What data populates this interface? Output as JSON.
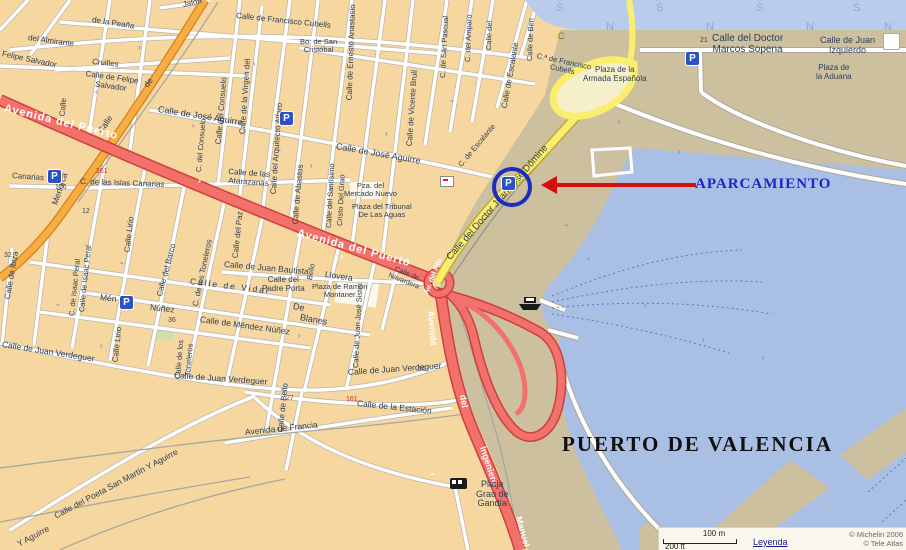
{
  "map": {
    "port_title": "PUERTO DE VALENCIA",
    "annotation": {
      "label": "APARCAMIENTO"
    },
    "legend": {
      "scale_m": "100 m",
      "scale_ft": "200 ft",
      "link": "Leyenda",
      "copyright1": "© Michelin 2006",
      "copyright2": "© Tele Atlas"
    },
    "colors": {
      "background_city": "#F7D7A0",
      "port_land": "#CDC09E",
      "water": "#A9BFE4",
      "water_top": "#B9CCEC",
      "road_red": "#F3716B",
      "road_orange": "#F7AD42",
      "road_yellow": "#FBEE6E",
      "parking_blue": "#2B51C8",
      "annotation_blue": "#2121CE",
      "arrow_red": "#D40F0F"
    },
    "parking_glyph": "P",
    "parking": [
      {
        "x": 48,
        "y": 170,
        "circled": false
      },
      {
        "x": 280,
        "y": 112,
        "circled": false
      },
      {
        "x": 120,
        "y": 296,
        "circled": false
      },
      {
        "x": 686,
        "y": 52,
        "circled": false
      },
      {
        "x": 502,
        "y": 177,
        "circled": true
      }
    ],
    "labels": [
      {
        "t": "Jalón",
        "x": 183,
        "y": 1,
        "r": -12,
        "s": 8
      },
      {
        "t": "Calle de Francisco Cubells",
        "x": 236,
        "y": 12,
        "r": 6,
        "s": 8
      },
      {
        "t": "de  la  Peaña",
        "x": 92,
        "y": 16,
        "r": 9,
        "s": 8
      },
      {
        "t": "del Almirante",
        "x": 28,
        "y": 34,
        "r": 8,
        "s": 8
      },
      {
        "t": "Felipe Salvador",
        "x": 2,
        "y": 50,
        "r": 12,
        "s": 8
      },
      {
        "t": "Cruilles",
        "x": 92,
        "y": 58,
        "r": 6,
        "s": 8
      },
      {
        "t": "Calle de Felipe\nSalvador",
        "x": 85,
        "y": 70,
        "r": 8,
        "s": 8,
        "ctr": 1
      },
      {
        "t": "Calle",
        "x": 63,
        "y": 112,
        "r": -85,
        "s": 8
      },
      {
        "t": "Calle",
        "x": 100,
        "y": 128,
        "r": -56,
        "s": 8.5
      },
      {
        "t": "de",
        "x": 146,
        "y": 82,
        "r": -56,
        "s": 8.5
      },
      {
        "t": "Menorca",
        "x": 55,
        "y": 200,
        "r": -72,
        "s": 8.5
      },
      {
        "t": "Avenida del Puerto",
        "x": 4,
        "y": 103,
        "r": 14,
        "s": 11,
        "c": "#ffffff",
        "b": 1,
        "ls": 1
      },
      {
        "t": "Avenida del Puerto",
        "x": 297,
        "y": 228,
        "r": 15,
        "s": 11,
        "c": "#ffffff",
        "b": 1,
        "ls": 1
      },
      {
        "t": "Canarias",
        "x": 12,
        "y": 172,
        "r": 4,
        "s": 8
      },
      {
        "t": "C. de las Islas Canarias",
        "x": 80,
        "y": 178,
        "r": 2,
        "s": 8
      },
      {
        "t": "Calle de Ernesto Anastasio",
        "x": 350,
        "y": 96,
        "r": -88,
        "s": 8
      },
      {
        "t": "Calle de Vicente Brull",
        "x": 410,
        "y": 142,
        "r": -86,
        "s": 8
      },
      {
        "t": "C. de San Pascual",
        "x": 443,
        "y": 74,
        "r": -87,
        "s": 7.5
      },
      {
        "t": "C. del Amparo",
        "x": 468,
        "y": 58,
        "r": -88,
        "s": 7.5
      },
      {
        "t": "Calle del",
        "x": 489,
        "y": 46,
        "r": -88,
        "s": 7.5
      },
      {
        "t": "Calle de Escalante",
        "x": 505,
        "y": 104,
        "r": -80,
        "s": 8
      },
      {
        "t": "C. de Escalante",
        "x": 460,
        "y": 162,
        "r": -50,
        "s": 7.5
      },
      {
        "t": "Calle de Ben",
        "x": 530,
        "y": 57,
        "r": -88,
        "s": 7.5
      },
      {
        "t": "C.ª de Francisco\nCubells",
        "x": 536,
        "y": 52,
        "r": 12,
        "s": 7.5,
        "ctr": 1
      },
      {
        "t": "Calle de José Aguirre",
        "x": 158,
        "y": 105,
        "r": 9,
        "s": 9
      },
      {
        "t": "Calle de José  Aguirre",
        "x": 336,
        "y": 142,
        "r": 10,
        "s": 9
      },
      {
        "t": "Calle del Consuelo",
        "x": 219,
        "y": 140,
        "r": -85,
        "s": 8
      },
      {
        "t": "C. del Consuelo",
        "x": 199,
        "y": 168,
        "r": -85,
        "s": 7.5
      },
      {
        "t": "Calle de la Virgen del",
        "x": 243,
        "y": 130,
        "r": -86,
        "s": 8
      },
      {
        "t": "Calle del Arquitecto Alfaro",
        "x": 274,
        "y": 190,
        "r": -86,
        "s": 8
      },
      {
        "t": "Calle de las\nAtarazanas",
        "x": 228,
        "y": 168,
        "r": 4,
        "s": 8,
        "ctr": 1
      },
      {
        "t": "Bo. de San\nCristóbal",
        "x": 300,
        "y": 38,
        "s": 7.5,
        "ctr": 1
      },
      {
        "t": "Pza. del\nMercado Nuevo",
        "x": 344,
        "y": 182,
        "s": 7.5,
        "ctr": 1
      },
      {
        "t": "Plaza del Tribunal\nDe Las Aguas",
        "x": 352,
        "y": 203,
        "s": 7.5,
        "ctr": 1
      },
      {
        "t": "Calle de Abastos",
        "x": 296,
        "y": 220,
        "r": -85,
        "s": 8
      },
      {
        "t": "Calle del Santísimo",
        "x": 329,
        "y": 224,
        "r": -87,
        "s": 7.5
      },
      {
        "t": "Cristo Del Grao",
        "x": 340,
        "y": 222,
        "r": -87,
        "s": 7.5
      },
      {
        "t": "Calle de Ibiza",
        "x": 8,
        "y": 295,
        "r": -80,
        "s": 8
      },
      {
        "t": "Calle de Isaac Peral",
        "x": 82,
        "y": 308,
        "r": -84,
        "s": 7.5
      },
      {
        "t": "C. de Isaac Peral",
        "x": 72,
        "y": 312,
        "r": -84,
        "s": 7.5
      },
      {
        "t": "Calle Lirio",
        "x": 128,
        "y": 248,
        "r": -84,
        "s": 8
      },
      {
        "t": "Calle Lirio",
        "x": 116,
        "y": 358,
        "r": -84,
        "s": 8
      },
      {
        "t": "Calle del Barco",
        "x": 160,
        "y": 292,
        "r": -75,
        "s": 8
      },
      {
        "t": "C. de los Toneleros",
        "x": 196,
        "y": 302,
        "r": -78,
        "s": 8
      },
      {
        "t": "Calle de los",
        "x": 178,
        "y": 375,
        "r": -85,
        "s": 7.5
      },
      {
        "t": "Toneleros",
        "x": 188,
        "y": 372,
        "r": -85,
        "s": 7.5
      },
      {
        "t": "Calle del Paz",
        "x": 236,
        "y": 254,
        "r": -84,
        "s": 8
      },
      {
        "t": "Calle de Juan Bautista",
        "x": 224,
        "y": 260,
        "r": 5,
        "s": 8.5
      },
      {
        "t": "Llovera",
        "x": 325,
        "y": 270,
        "r": 8,
        "s": 8.5
      },
      {
        "t": "Calle del\nPadre Porta",
        "x": 262,
        "y": 276,
        "s": 8,
        "ctr": 1
      },
      {
        "t": "Plaza de Ramón\nMontaner",
        "x": 312,
        "y": 283,
        "s": 7.5,
        "ctr": 1
      },
      {
        "t": "Calle   de   Vidal",
        "x": 190,
        "y": 277,
        "r": 7,
        "s": 8.5,
        "ls": 2
      },
      {
        "t": "Mén",
        "x": 100,
        "y": 293,
        "r": 6,
        "s": 8.5
      },
      {
        "t": "Núñez",
        "x": 150,
        "y": 303,
        "r": 6,
        "s": 8.5
      },
      {
        "t": "Calle de Méndez  Núñez",
        "x": 200,
        "y": 315,
        "r": 8,
        "s": 8.5
      },
      {
        "t": "De",
        "x": 293,
        "y": 302,
        "r": 10,
        "s": 9
      },
      {
        "t": "Blanes",
        "x": 300,
        "y": 313,
        "r": 10,
        "s": 9
      },
      {
        "t": "Calle de Bello",
        "x": 281,
        "y": 428,
        "r": -84,
        "s": 8
      },
      {
        "t": "Bello",
        "x": 310,
        "y": 276,
        "r": -80,
        "s": 7.5
      },
      {
        "t": "Calle de Juan José Sister",
        "x": 356,
        "y": 364,
        "r": -87,
        "s": 7.5
      },
      {
        "t": "Calle de\nNavardera",
        "x": 390,
        "y": 264,
        "r": 22,
        "s": 7,
        "ctr": 1
      },
      {
        "t": "Calle de Juan Verdeguer",
        "x": 2,
        "y": 340,
        "r": 9,
        "s": 8.5
      },
      {
        "t": "Calle de Juan Verdeguer",
        "x": 174,
        "y": 371,
        "r": 4,
        "s": 8.5
      },
      {
        "t": "Calle de Juan Verdeguer",
        "x": 348,
        "y": 368,
        "r": -4,
        "s": 8.5
      },
      {
        "t": "Calle de  la Estación",
        "x": 357,
        "y": 399,
        "r": 6,
        "s": 8.5
      },
      {
        "t": "Avenida  de  Francia",
        "x": 245,
        "y": 428,
        "r": -6,
        "s": 8.5
      },
      {
        "t": "Calle del Poeta San Martín Y Aguirre",
        "x": 55,
        "y": 512,
        "r": -28,
        "s": 8.5
      },
      {
        "t": "Y Aguirre",
        "x": 18,
        "y": 540,
        "r": -28,
        "s": 8.5
      },
      {
        "t": "Av. del Pto.",
        "x": 426,
        "y": 290,
        "r": -68,
        "s": 7.5,
        "c": "#ffffff",
        "b": 1
      },
      {
        "t": "Avenida",
        "x": 430,
        "y": 306,
        "r": 85,
        "s": 9,
        "c": "#ffffff",
        "b": 1
      },
      {
        "t": "del",
        "x": 462,
        "y": 390,
        "r": 80,
        "s": 9,
        "c": "#ffffff",
        "b": 1
      },
      {
        "t": "Ingeniero",
        "x": 482,
        "y": 442,
        "r": 72,
        "s": 9,
        "c": "#ffffff",
        "b": 1
      },
      {
        "t": "Manuel",
        "x": 518,
        "y": 512,
        "r": 75,
        "s": 9,
        "c": "#ffffff",
        "b": 1
      },
      {
        "t": "Calle del Doctor Juan José Dómine",
        "x": 449,
        "y": 254,
        "r": -49,
        "s": 9.5
      },
      {
        "t": "Calle del Doctor\nMarcos Sopena",
        "x": 712,
        "y": 34,
        "s": 10,
        "ctr": 1
      },
      {
        "t": "Calle de Juan\nIzquierdo",
        "x": 820,
        "y": 36,
        "s": 9,
        "ctr": 1
      },
      {
        "t": "Plaza de\nla Aduana",
        "x": 816,
        "y": 64,
        "s": 8,
        "ctr": 1
      },
      {
        "t": "Plaza de la\nArmada Española",
        "x": 583,
        "y": 66,
        "s": 8,
        "ctr": 1
      },
      {
        "t": "Platja\nGrau de\nGandía",
        "x": 476,
        "y": 480,
        "s": 9,
        "ctr": 1
      },
      {
        "t": "C",
        "x": 558,
        "y": 32,
        "s": 9,
        "c": "#8a7a00",
        "n": "road-badge"
      },
      {
        "t": "21",
        "x": 700,
        "y": 37,
        "s": 7,
        "c": "#444444",
        "n": "house-number"
      },
      {
        "t": "161",
        "x": 346,
        "y": 396,
        "s": 7,
        "c": "#C03020",
        "n": "house-number"
      },
      {
        "t": "50",
        "x": 418,
        "y": 366,
        "s": 7,
        "c": "#444444",
        "n": "house-number"
      },
      {
        "t": "261",
        "x": 96,
        "y": 168,
        "s": 7,
        "c": "#C03020",
        "n": "house-number"
      },
      {
        "t": "176",
        "x": 55,
        "y": 184,
        "s": 7,
        "c": "#444444",
        "n": "house-number"
      },
      {
        "t": "12",
        "x": 82,
        "y": 208,
        "s": 7,
        "c": "#444444",
        "n": "house-number"
      },
      {
        "t": "32",
        "x": 4,
        "y": 252,
        "s": 7,
        "c": "#444444",
        "n": "house-number"
      },
      {
        "t": "36",
        "x": 168,
        "y": 317,
        "s": 7,
        "c": "#444444",
        "n": "house-number"
      },
      {
        "t": "27",
        "x": 286,
        "y": 395,
        "s": 7,
        "c": "#C03020",
        "n": "house-number"
      },
      {
        "t": "Ṡ",
        "x": 556,
        "y": 3,
        "s": 11,
        "c": "#8FA9D6",
        "n": "water-symbol"
      },
      {
        "t": "Ṡ",
        "x": 656,
        "y": 3,
        "s": 11,
        "c": "#8FA9D6",
        "n": "water-symbol"
      },
      {
        "t": "Ṡ",
        "x": 756,
        "y": 3,
        "s": 11,
        "c": "#8FA9D6",
        "n": "water-symbol"
      },
      {
        "t": "Ṡ",
        "x": 853,
        "y": 3,
        "s": 11,
        "c": "#8FA9D6",
        "n": "water-symbol"
      },
      {
        "t": "N",
        "x": 606,
        "y": 22,
        "s": 11,
        "c": "#8FA9D6",
        "n": "water-symbol"
      },
      {
        "t": "N",
        "x": 706,
        "y": 22,
        "s": 11,
        "c": "#8FA9D6",
        "n": "water-symbol"
      },
      {
        "t": "N",
        "x": 806,
        "y": 22,
        "s": 11,
        "c": "#8FA9D6",
        "n": "water-symbol"
      },
      {
        "t": "N",
        "x": 884,
        "y": 22,
        "s": 11,
        "c": "#8FA9D6",
        "n": "water-symbol"
      },
      {
        "t": "›",
        "x": 138,
        "y": 44,
        "s": 8,
        "c": "#5578D8",
        "n": "direction-arrow"
      },
      {
        "t": "‹",
        "x": 95,
        "y": 88,
        "s": 8,
        "c": "#5578D8",
        "n": "direction-arrow"
      },
      {
        "t": "‹",
        "x": 253,
        "y": 60,
        "s": 8,
        "c": "#5578D8",
        "n": "direction-arrow"
      },
      {
        "t": "›",
        "x": 192,
        "y": 122,
        "s": 8,
        "c": "#5578D8",
        "n": "direction-arrow"
      },
      {
        "t": "›",
        "x": 385,
        "y": 130,
        "s": 8,
        "c": "#5578D8",
        "n": "direction-arrow"
      },
      {
        "t": "‹",
        "x": 310,
        "y": 162,
        "s": 8,
        "c": "#5578D8",
        "n": "direction-arrow"
      },
      {
        "t": "‹",
        "x": 452,
        "y": 98,
        "r": -80,
        "s": 8,
        "c": "#5578D8",
        "n": "direction-arrow"
      },
      {
        "t": "‹",
        "x": 100,
        "y": 342,
        "s": 8,
        "c": "#5578D8",
        "n": "direction-arrow"
      },
      {
        "t": "›",
        "x": 298,
        "y": 332,
        "s": 8,
        "c": "#5578D8",
        "n": "direction-arrow"
      },
      {
        "t": "‹",
        "x": 122,
        "y": 260,
        "r": -80,
        "s": 8,
        "c": "#5578D8",
        "n": "direction-arrow"
      },
      {
        "t": "›",
        "x": 58,
        "y": 302,
        "r": -80,
        "s": 8,
        "c": "#5578D8",
        "n": "direction-arrow"
      },
      {
        "t": "‹",
        "x": 618,
        "y": 118,
        "s": 8,
        "c": "#5578D8",
        "n": "direction-arrow"
      },
      {
        "t": "›",
        "x": 678,
        "y": 148,
        "s": 8,
        "c": "#5578D8",
        "n": "direction-arrow"
      },
      {
        "t": "‹",
        "x": 644,
        "y": 302,
        "s": 8,
        "c": "#5578D8",
        "n": "direction-arrow"
      },
      {
        "t": "›",
        "x": 702,
        "y": 336,
        "s": 8,
        "c": "#5578D8",
        "n": "direction-arrow"
      },
      {
        "t": "‹",
        "x": 762,
        "y": 354,
        "s": 8,
        "c": "#5578D8",
        "n": "direction-arrow"
      },
      {
        "t": "›",
        "x": 588,
        "y": 256,
        "r": -55,
        "s": 8,
        "c": "#5578D8",
        "n": "direction-arrow"
      },
      {
        "t": "‹",
        "x": 566,
        "y": 222,
        "r": -55,
        "s": 8,
        "c": "#5578D8",
        "n": "direction-arrow"
      },
      {
        "t": "›",
        "x": 472,
        "y": 232,
        "r": -55,
        "s": 8,
        "c": "#5578D8",
        "n": "direction-arrow"
      },
      {
        "t": "›",
        "x": 198,
        "y": 176,
        "r": 14,
        "s": 9,
        "c": "#ffffff",
        "b": 1,
        "n": "direction-arrow"
      },
      {
        "t": "›",
        "x": 340,
        "y": 252,
        "r": 14,
        "s": 9,
        "c": "#ffffff",
        "b": 1,
        "n": "direction-arrow"
      },
      {
        "t": "‹",
        "x": 432,
        "y": 468,
        "r": 85,
        "s": 9,
        "c": "#ffffff",
        "b": 1,
        "n": "direction-arrow"
      }
    ]
  }
}
